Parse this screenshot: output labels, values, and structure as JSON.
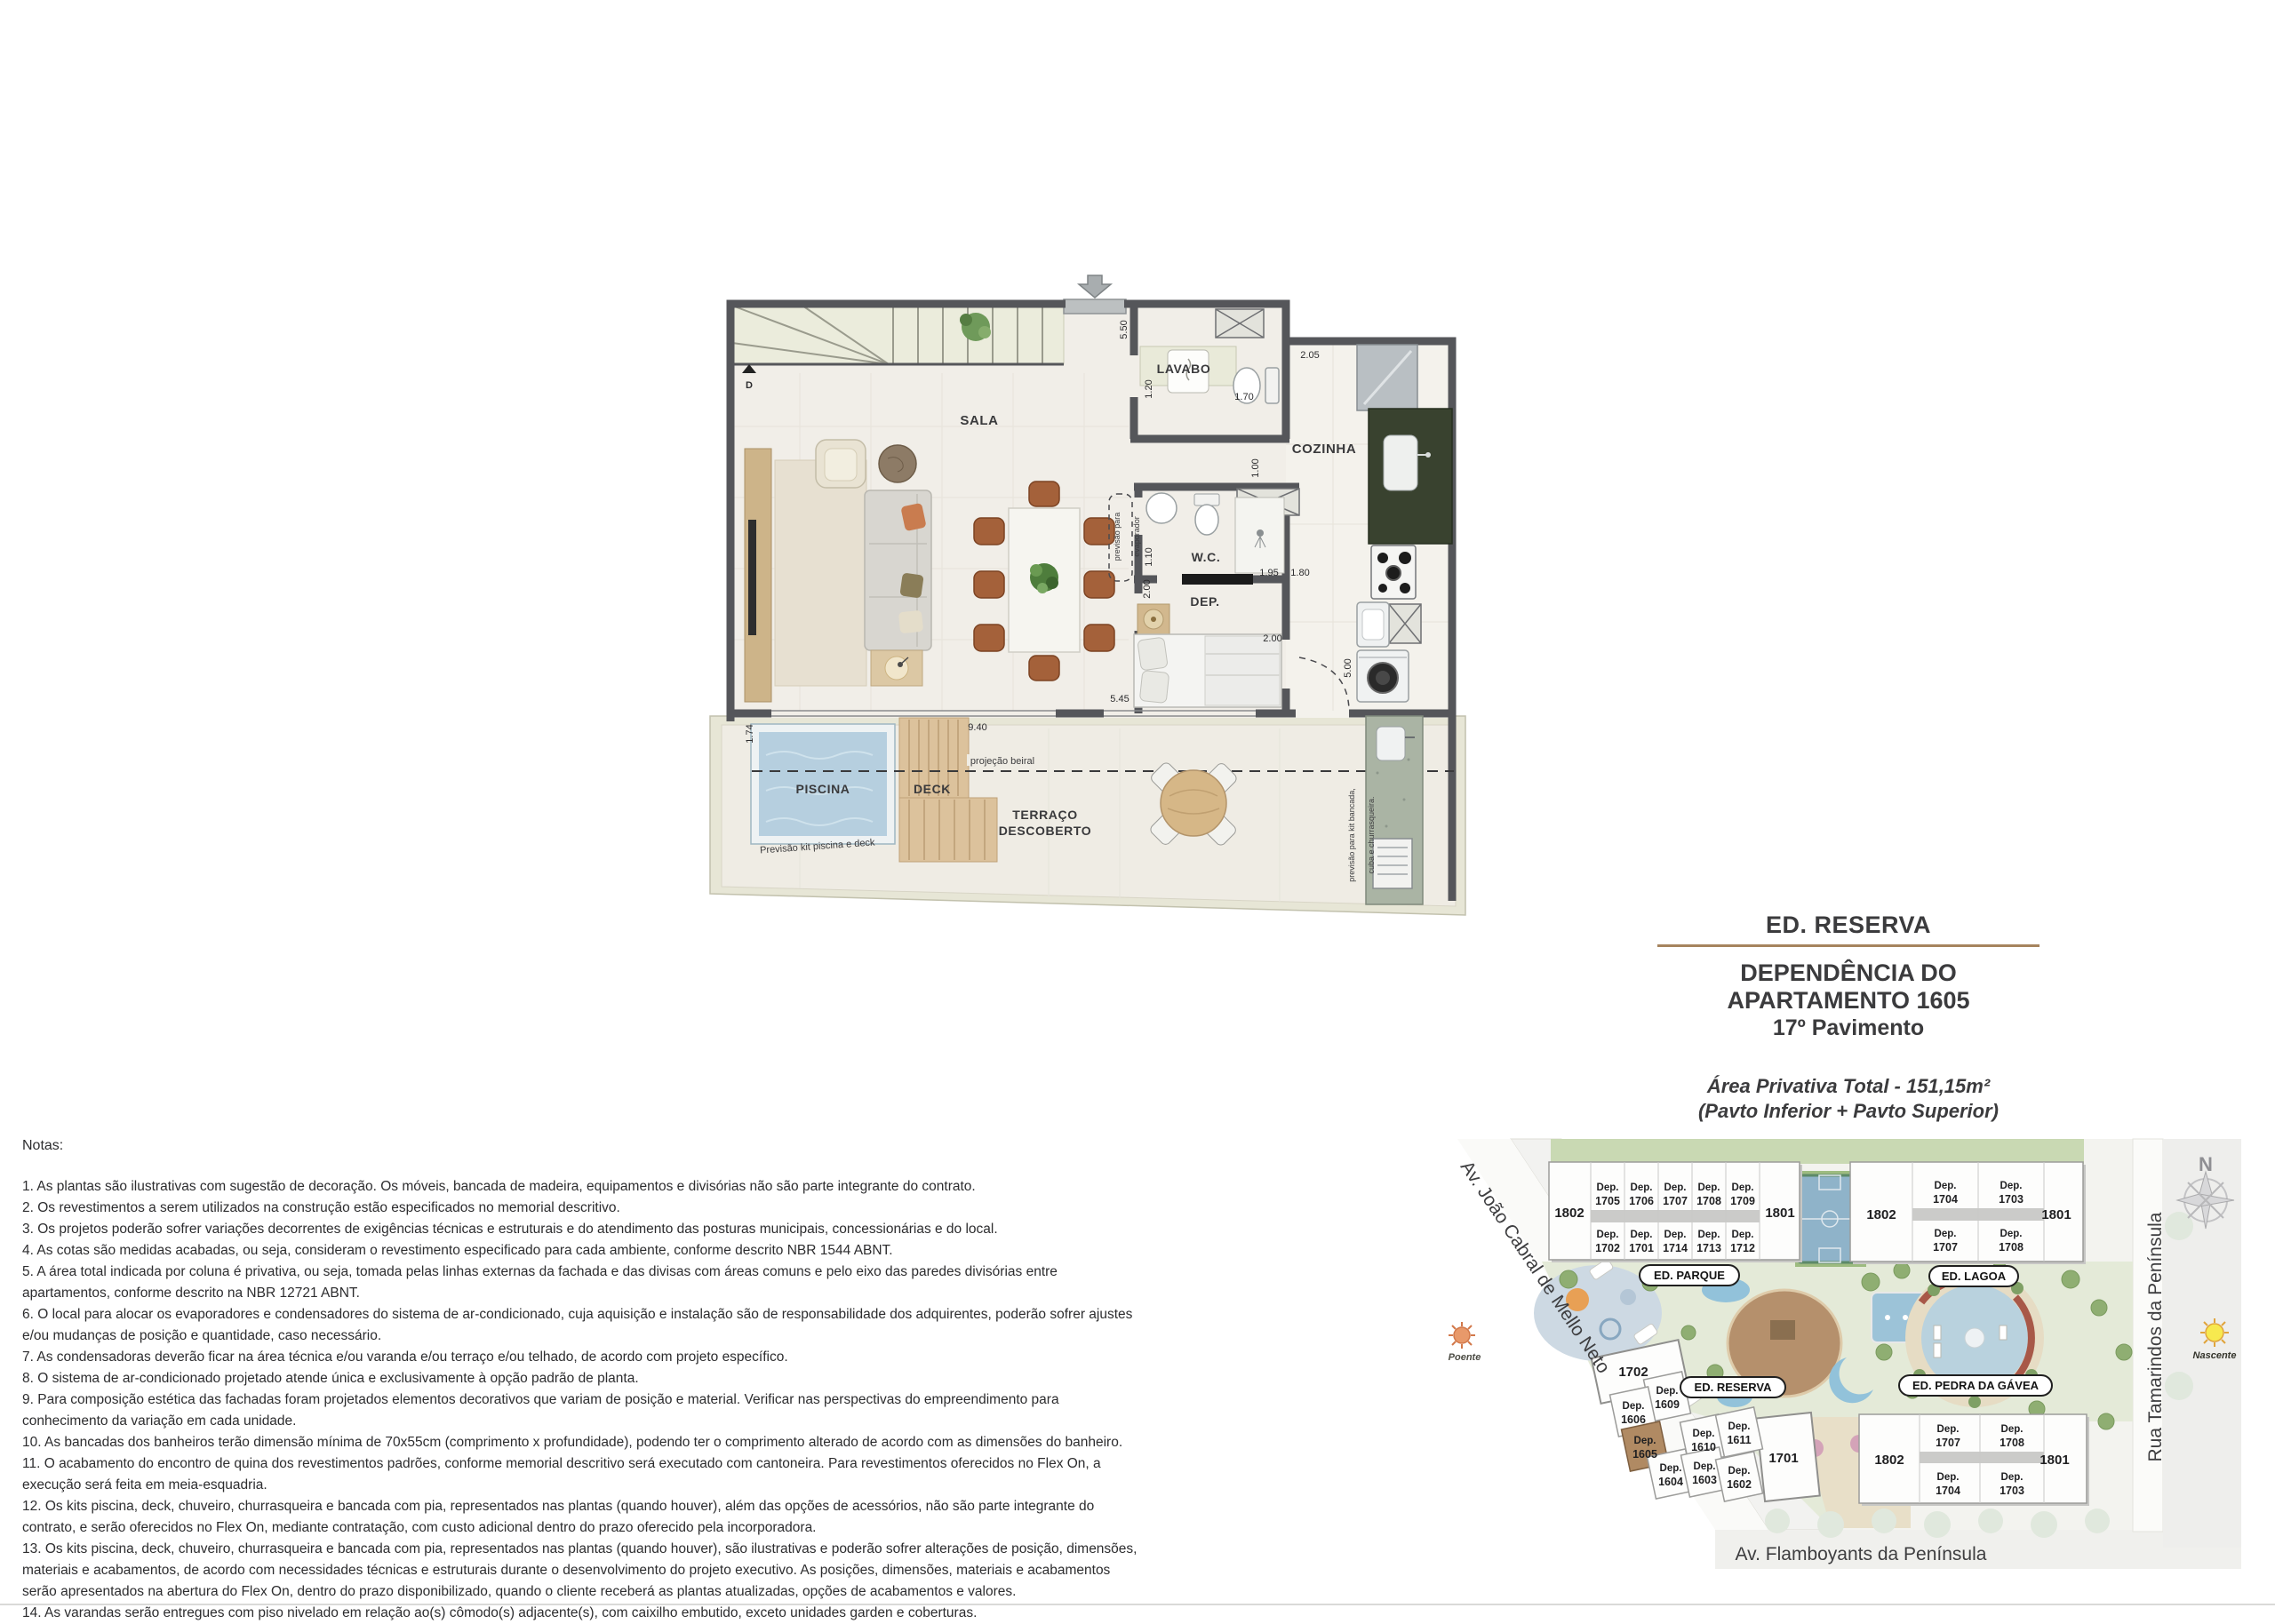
{
  "colors": {
    "wall": "#55565a",
    "floor": "#f1eee8",
    "pool_water": "#b6cfdf",
    "deck_wood": "#dcc29c",
    "chair_leather": "#a4613a",
    "counter_granite": "#39422f",
    "title_rule": "#a6845e",
    "unit_highlight": "#b08a63",
    "map_green": "#dfe7cd",
    "court_blue": "#8fb3c9"
  },
  "title_block": {
    "building": "ED. RESERVA",
    "line1": "DEPENDÊNCIA DO",
    "line2": "APARTAMENTO 1605",
    "line3": "17º Pavimento",
    "area1": "Área Privativa Total - 151,15m²",
    "area2": "(Pavto Inferior + Pavto Superior)"
  },
  "plan": {
    "rooms": {
      "sala": "SALA",
      "lavabo": "LAVABO",
      "cozinha": "COZINHA",
      "wc": "W.C.",
      "dep": "DEP.",
      "piscina": "PISCINA",
      "deck": "DECK",
      "terraco1": "TERRAÇO",
      "terraco2": "DESCOBERTO"
    },
    "dims": {
      "d550": "5.50",
      "d120": "1.20",
      "d170": "1.70",
      "d205": "2.05",
      "d100": "1.00",
      "d110": "1.10",
      "d195": "1.95",
      "d180": "1.80",
      "d200a": "2.00",
      "d200b": "2.00",
      "d500": "5.00",
      "d174": "1.74",
      "d940": "9.40",
      "d545": "5.45"
    },
    "annotations": {
      "evap1": "previsão para",
      "evap2": "evaporador",
      "beiral": "projeção beiral",
      "kit_piscina": "Previsão kit piscina e deck",
      "kit_banc1": "previsão para kit bancada,",
      "kit_banc2": "cuba e churrasqueira.",
      "stair_d": "D"
    }
  },
  "notes": {
    "heading": "Notas:",
    "items": [
      "1. As plantas são ilustrativas com sugestão de decoração. Os móveis, bancada de madeira, equipamentos e divisórias não são parte integrante do contrato.",
      "2. Os revestimentos a serem utilizados na construção estão especificados no memorial descritivo.",
      "3. Os projetos poderão sofrer variações decorrentes de exigências técnicas e estruturais e do atendimento das posturas municipais, concessionárias e do local.",
      "4. As cotas são medidas acabadas, ou seja, consideram o revestimento especificado para cada ambiente, conforme descrito NBR 1544 ABNT.",
      "5. A área total indicada por coluna é privativa, ou seja, tomada pelas linhas externas da fachada e das divisas com áreas comuns e pelo eixo das paredes divisórias entre apartamentos, conforme descrito na NBR 12721 ABNT.",
      "6. O local para alocar os evaporadores e condensadores do sistema de ar-condicionado, cuja aquisição e instalação são de responsabilidade dos adquirentes, poderão sofrer ajustes e/ou mudanças de posição e quantidade, caso necessário.",
      "7. As condensadoras deverão ficar na área técnica e/ou varanda e/ou terraço e/ou telhado, de acordo com projeto específico.",
      "8. O sistema de ar-condicionado projetado atende única e exclusivamente à opção padrão de planta.",
      "9. Para composição estética das fachadas foram projetados elementos decorativos que variam de posição e material. Verificar nas perspectivas do empreendimento para conhecimento da variação em cada unidade.",
      "10. As bancadas dos banheiros terão dimensão mínima de 70x55cm (comprimento x profundidade), podendo ter o comprimento alterado de acordo com as dimensões do banheiro.",
      "11. O acabamento do encontro de quina dos revestimentos padrões, conforme memorial descritivo será executado com cantoneira. Para revestimentos oferecidos no Flex On, a execução será feita em meia-esquadria.",
      "12. Os kits piscina, deck, chuveiro, churrasqueira e bancada com pia, representados nas plantas (quando houver), além das opções de acessórios, não são parte integrante do contrato, e serão oferecidos no Flex On, mediante contratação, com custo adicional dentro do prazo oferecido pela incorporadora.",
      "13. Os kits piscina, deck, chuveiro, churrasqueira e bancada com pia, representados nas plantas (quando houver), são ilustrativas e poderão sofrer alterações de posição, dimensões, materiais e acabamentos, de acordo com necessidades técnicas e estruturais durante o desenvolvimento do projeto executivo. As posições, dimensões, materiais e acabamentos serão apresentados na abertura do Flex On, dentro do prazo disponibilizado, quando o cliente receberá as plantas atualizadas, opções de acabamentos e valores.",
      "14. As varandas serão entregues com piso nivelado em relação ao(s) cômodo(s) adjacente(s), com caixilho embutido, exceto unidades garden e coberturas."
    ]
  },
  "sitemap": {
    "dep_prefix": "Dep.",
    "streets": {
      "west": "Av. João Cabral de Mello Neto",
      "south": "Av. Flamboyants da Península",
      "east": "Rua Tamarindos da Península"
    },
    "compass_n": "N",
    "sun_west": "Poente",
    "sun_east": "Nascente",
    "building_labels": {
      "parque": "ED. PARQUE",
      "lagoa": "ED. LAGOA",
      "reserva": "ED. RESERVA",
      "pedra": "ED. PEDRA DA GÁVEA"
    },
    "parque": {
      "left": "1802",
      "right": "1801",
      "top": [
        "1705",
        "1706",
        "1707",
        "1708",
        "1709"
      ],
      "bottom": [
        "1702",
        "1701",
        "1714",
        "1713",
        "1712"
      ]
    },
    "lagoa": {
      "left": "1802",
      "right": "1801",
      "top": [
        "1704",
        "1703"
      ],
      "bottom": [
        "1707",
        "1708"
      ]
    },
    "pedra_bld": {
      "left": "1802",
      "right": "1801",
      "top": [
        "1707",
        "1708"
      ],
      "bottom": [
        "1704",
        "1703"
      ]
    },
    "reserva_bld": {
      "b1702": "1702",
      "b1701": "1701",
      "u1609": "1609",
      "u1606": "1606",
      "u1605": "1605",
      "u1610": "1610",
      "u1611": "1611",
      "u1604": "1604",
      "u1603": "1603",
      "u1602": "1602"
    }
  }
}
